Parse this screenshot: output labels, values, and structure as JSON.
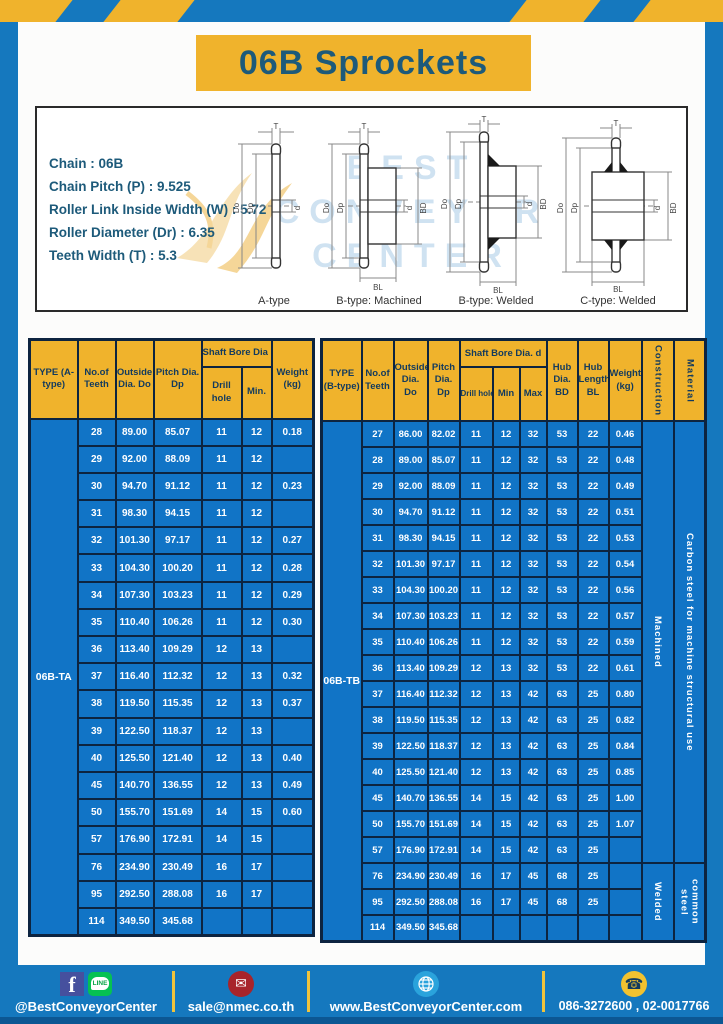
{
  "title": "06B Sprockets",
  "specs": {
    "lines": [
      "Chain : 06B",
      "Chain Pitch (P) : 9.525",
      "Roller Link Inside Width (W) : 5.72",
      "Roller Diameter (Dr) : 6.35",
      "Teeth Width (T) : 5.3"
    ]
  },
  "diagram": {
    "captions": [
      "A-type",
      "B-type: Machined",
      "B-type: Welded",
      "C-type: Welded"
    ],
    "dims": {
      "T": "T",
      "Do": "Do",
      "Dp": "Dp",
      "d": "d",
      "BD": "BD",
      "BL": "BL"
    },
    "watermark": [
      "BEST",
      "CONVEYOR",
      "CENTER"
    ]
  },
  "table_a": {
    "headers": {
      "type": "TYPE (A-type)",
      "teeth": "No.of Teeth",
      "outside": "Outside Dia. Do",
      "pitch": "Pitch Dia. Dp",
      "shaft_bore": "Shaft Bore Dia d",
      "drill": "Drill hole",
      "min": "Min.",
      "weight": "Weight (kg)"
    },
    "type_label": "06B-TA",
    "rows": [
      [
        "28",
        "89.00",
        "85.07",
        "11",
        "12",
        "0.18"
      ],
      [
        "29",
        "92.00",
        "88.09",
        "11",
        "12",
        ""
      ],
      [
        "30",
        "94.70",
        "91.12",
        "11",
        "12",
        "0.23"
      ],
      [
        "31",
        "98.30",
        "94.15",
        "11",
        "12",
        ""
      ],
      [
        "32",
        "101.30",
        "97.17",
        "11",
        "12",
        "0.27"
      ],
      [
        "33",
        "104.30",
        "100.20",
        "11",
        "12",
        "0.28"
      ],
      [
        "34",
        "107.30",
        "103.23",
        "11",
        "12",
        "0.29"
      ],
      [
        "35",
        "110.40",
        "106.26",
        "11",
        "12",
        "0.30"
      ],
      [
        "36",
        "113.40",
        "109.29",
        "12",
        "13",
        ""
      ],
      [
        "37",
        "116.40",
        "112.32",
        "12",
        "13",
        "0.32"
      ],
      [
        "38",
        "119.50",
        "115.35",
        "12",
        "13",
        "0.37"
      ],
      [
        "39",
        "122.50",
        "118.37",
        "12",
        "13",
        ""
      ],
      [
        "40",
        "125.50",
        "121.40",
        "12",
        "13",
        "0.40"
      ],
      [
        "45",
        "140.70",
        "136.55",
        "12",
        "13",
        "0.49"
      ],
      [
        "50",
        "155.70",
        "151.69",
        "14",
        "15",
        "0.60"
      ],
      [
        "57",
        "176.90",
        "172.91",
        "14",
        "15",
        ""
      ],
      [
        "76",
        "234.90",
        "230.49",
        "16",
        "17",
        ""
      ],
      [
        "95",
        "292.50",
        "288.08",
        "16",
        "17",
        ""
      ],
      [
        "114",
        "349.50",
        "345.68",
        "",
        "",
        ""
      ]
    ]
  },
  "table_b": {
    "headers": {
      "type": "TYPE (B-type)",
      "teeth": "No.of Teeth",
      "outside": "Outside Dia. Do",
      "pitch": "Pitch Dia. Dp",
      "shaft_bore": "Shaft Bore Dia. d",
      "drill": "Drill hole",
      "min": "Min",
      "max": "Max",
      "hub_dia": "Hub Dia. BD",
      "hub_len": "Hub Length BL",
      "weight": "Weight (kg)",
      "construction": "Construction",
      "material": "Material"
    },
    "type_label": "06B-TB",
    "construction": {
      "machined": "Machined",
      "welded": "Welded"
    },
    "material": {
      "machined": "Carbon steel for machine structural use",
      "welded": "common steel"
    },
    "machined_row_count": 17,
    "rows": [
      [
        "27",
        "86.00",
        "82.02",
        "11",
        "12",
        "32",
        "53",
        "22",
        "0.46"
      ],
      [
        "28",
        "89.00",
        "85.07",
        "11",
        "12",
        "32",
        "53",
        "22",
        "0.48"
      ],
      [
        "29",
        "92.00",
        "88.09",
        "11",
        "12",
        "32",
        "53",
        "22",
        "0.49"
      ],
      [
        "30",
        "94.70",
        "91.12",
        "11",
        "12",
        "32",
        "53",
        "22",
        "0.51"
      ],
      [
        "31",
        "98.30",
        "94.15",
        "11",
        "12",
        "32",
        "53",
        "22",
        "0.53"
      ],
      [
        "32",
        "101.30",
        "97.17",
        "11",
        "12",
        "32",
        "53",
        "22",
        "0.54"
      ],
      [
        "33",
        "104.30",
        "100.20",
        "11",
        "12",
        "32",
        "53",
        "22",
        "0.56"
      ],
      [
        "34",
        "107.30",
        "103.23",
        "11",
        "12",
        "32",
        "53",
        "22",
        "0.57"
      ],
      [
        "35",
        "110.40",
        "106.26",
        "11",
        "12",
        "32",
        "53",
        "22",
        "0.59"
      ],
      [
        "36",
        "113.40",
        "109.29",
        "12",
        "13",
        "32",
        "53",
        "22",
        "0.61"
      ],
      [
        "37",
        "116.40",
        "112.32",
        "12",
        "13",
        "42",
        "63",
        "25",
        "0.80"
      ],
      [
        "38",
        "119.50",
        "115.35",
        "12",
        "13",
        "42",
        "63",
        "25",
        "0.82"
      ],
      [
        "39",
        "122.50",
        "118.37",
        "12",
        "13",
        "42",
        "63",
        "25",
        "0.84"
      ],
      [
        "40",
        "125.50",
        "121.40",
        "12",
        "13",
        "42",
        "63",
        "25",
        "0.85"
      ],
      [
        "45",
        "140.70",
        "136.55",
        "14",
        "15",
        "42",
        "63",
        "25",
        "1.00"
      ],
      [
        "50",
        "155.70",
        "151.69",
        "14",
        "15",
        "42",
        "63",
        "25",
        "1.07"
      ],
      [
        "57",
        "176.90",
        "172.91",
        "14",
        "15",
        "42",
        "63",
        "25",
        ""
      ],
      [
        "76",
        "234.90",
        "230.49",
        "16",
        "17",
        "45",
        "68",
        "25",
        ""
      ],
      [
        "95",
        "292.50",
        "288.08",
        "16",
        "17",
        "45",
        "68",
        "25",
        ""
      ],
      [
        "114",
        "349.50",
        "345.68",
        "",
        "",
        "",
        "",
        "",
        ""
      ]
    ]
  },
  "footer": {
    "social": "@BestConveyorCenter",
    "email": "sale@nmec.co.th",
    "website": "www.BestConveyorCenter.com",
    "phones": "086-3272600 , 02-0017766",
    "icons": {
      "facebook_glyph": "f",
      "line_badge": "LINE",
      "envelope_glyph": "✉",
      "phone_glyph": "☎"
    }
  },
  "colors": {
    "frame_blue": "#1578be",
    "banner_yellow": "#f0b32c",
    "table_blue": "#1174c6",
    "grid_navy": "#0d2440",
    "title_text": "#1d5a7a",
    "footer_strip": "#0c5793"
  }
}
